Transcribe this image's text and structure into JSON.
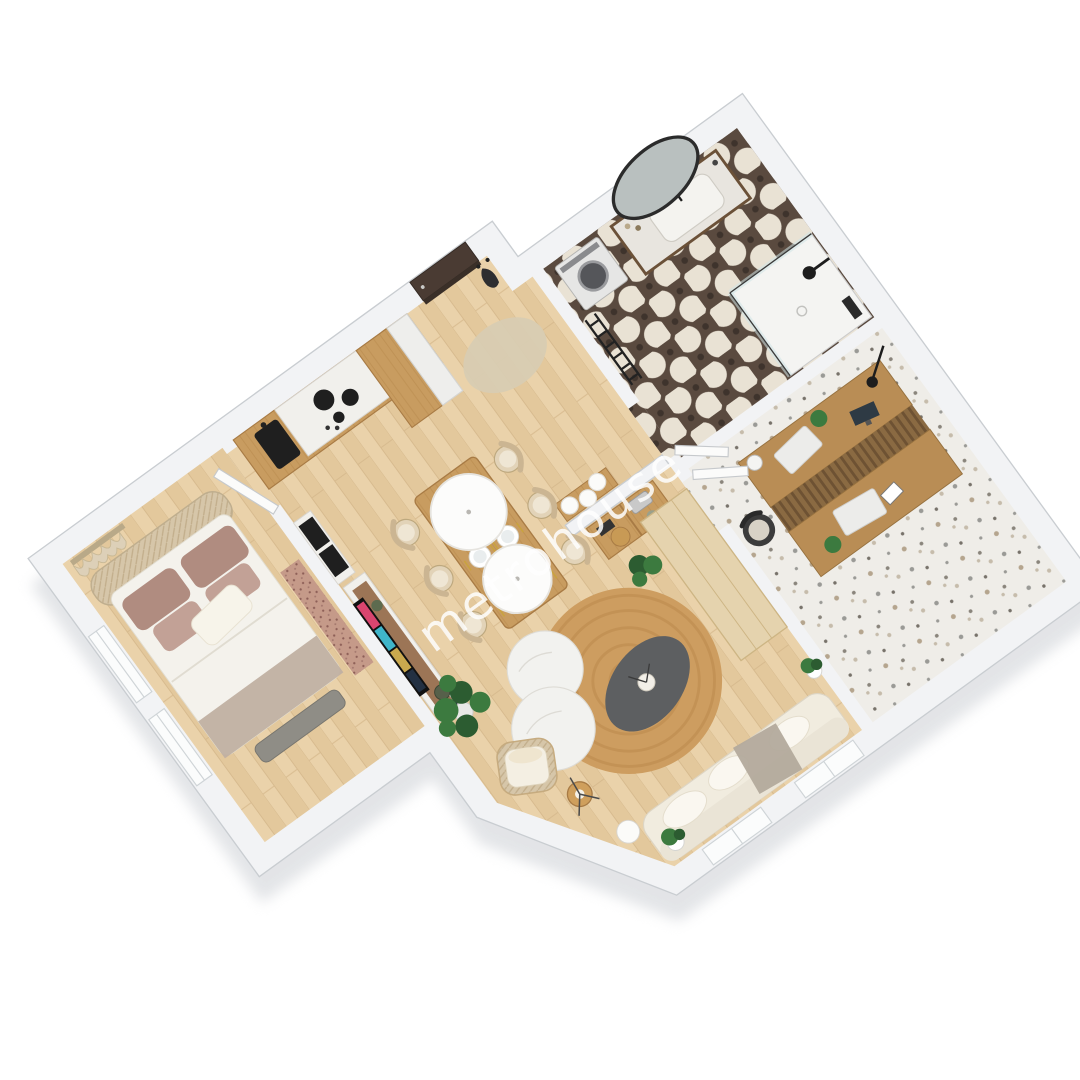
{
  "watermark": {
    "text": "metrohouse"
  },
  "palette": {
    "background": "#ffffff",
    "wall_top": "#f2f3f5",
    "wall_stroke": "#c9cdd1",
    "shadow": "#e0e2e5",
    "floor_oak": "#ead2aa",
    "floor_oak_dark": "#e3c89c",
    "plank_seam": "#d7ba8e",
    "cabinet_wood": "#c89c60",
    "cabinet_grain": "#b6884a",
    "counter": "#f1f0ec",
    "appliance_dark": "#1f1f1f",
    "tile_dark": "#5a4a3f",
    "tile_cream": "#e9e2d4",
    "terrazzo": "#efede8",
    "bed_duvet": "#f4f2ec",
    "pillow_mauve": "#b08c80",
    "pillow_mauve_light": "#c2a196",
    "pillow_white": "#f7f4ea",
    "headboard": "#d6c6a9",
    "bench": "#8f8d86",
    "runner": "#c59a89",
    "sofa": "#f1ecdf",
    "sofa_throw": "#b3aa9c",
    "rug_jute": "#cd9d60",
    "rug_jute_ring": "#b9854a",
    "rug_oval": "#d8ccb2",
    "coffee_dark": "#5d5f61",
    "marble": "#f2f2ef",
    "chair_tan": "#e2d3b8",
    "chair_stroke": "#bda87e",
    "plant": "#3c7a3f",
    "plant_dark": "#2c5c31",
    "desk_wood": "#b98d55",
    "walnut": "#8d5f3c",
    "door_dark": "#4a3b33",
    "glass": "#cfe3e6",
    "watermark_white": "#ffffff"
  },
  "rooms": [
    {
      "name": "bedroom",
      "items": [
        "double-bed",
        "curved-headboard",
        "mauve-pillows",
        "white-pillow",
        "foot-bench",
        "runner-rug",
        "curtains",
        "wall-windows",
        "open-door"
      ]
    },
    {
      "name": "kitchen",
      "items": [
        "cabinet-run",
        "white-counter",
        "cooktop",
        "sink",
        "tall-cabinets",
        "fridge-column",
        "oven-column"
      ]
    },
    {
      "name": "entry-hall",
      "items": [
        "front-door",
        "coat-rack",
        "oval-rug",
        "console-table",
        "pendant-ball-lamps"
      ]
    },
    {
      "name": "bathroom",
      "items": [
        "patterned-tile-floor",
        "washing-machine",
        "towel-ladder",
        "vanity-sink",
        "organic-mirror",
        "walk-in-shower"
      ]
    },
    {
      "name": "office",
      "items": [
        "terrazzo-floor",
        "double-desk",
        "slat-divider",
        "desk-chair",
        "laptops",
        "monitor",
        "arc-lamp",
        "open-door"
      ]
    },
    {
      "name": "living-dining",
      "items": [
        "dining-table",
        "six-chairs",
        "plates",
        "disc-pendants",
        "ladder-shelf",
        "tv-console",
        "tv",
        "jute-rug",
        "marble-coffee-tables",
        "dark-oval-table",
        "sofa",
        "rattan-armchair",
        "floor-lamp",
        "monstera-plants",
        "tall-beige-cabinet"
      ]
    }
  ]
}
